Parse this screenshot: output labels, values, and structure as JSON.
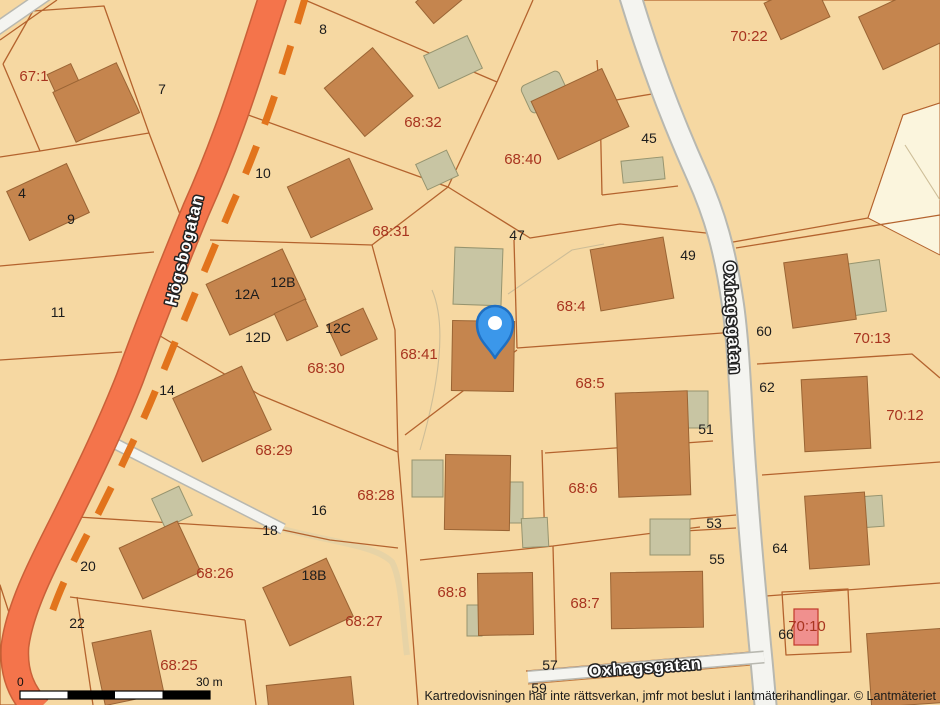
{
  "map": {
    "streets": {
      "hogsbogatan": "Högsbogatan",
      "oxhagsgatan": "Oxhagsgatan"
    },
    "parcels": [
      "67:1",
      "68:32",
      "68:40",
      "70:22",
      "68:31",
      "68:4",
      "68:30",
      "68:41",
      "70:13",
      "68:5",
      "70:12",
      "68:29",
      "68:28",
      "68:26",
      "68:6",
      "68:8",
      "68:7",
      "68:27",
      "68:25",
      "70:10"
    ],
    "house_numbers": [
      "8",
      "7",
      "10",
      "4",
      "9",
      "11",
      "12A",
      "12B",
      "12C",
      "12D",
      "14",
      "16",
      "18",
      "18B",
      "20",
      "22",
      "45",
      "47",
      "49",
      "51",
      "53",
      "55",
      "57",
      "59",
      "60",
      "62",
      "64",
      "66"
    ],
    "scale_bar": {
      "start": "0",
      "end": "30 m"
    },
    "attribution": "Kartredovisningen har inte rättsverkan, jmfr mot beslut i lantmäterihandlingar. © Lantmäteriet",
    "colors": {
      "background": "#f6d8a2",
      "parcel_pink": "#eabfa0",
      "cream_area": "#fbf5dd",
      "road_orange": "#f4744b",
      "road_dash": "#e2741c",
      "road_white": "#f4f4f0",
      "building": "#c5854e",
      "outbuilding": "#c8c5a3",
      "building_pink": "#f0908e",
      "boundary_line": "#b4632e",
      "parcel_label": "#a8341f",
      "house_number": "#1c1c1c",
      "marker_blue": "#3b97ea"
    }
  }
}
